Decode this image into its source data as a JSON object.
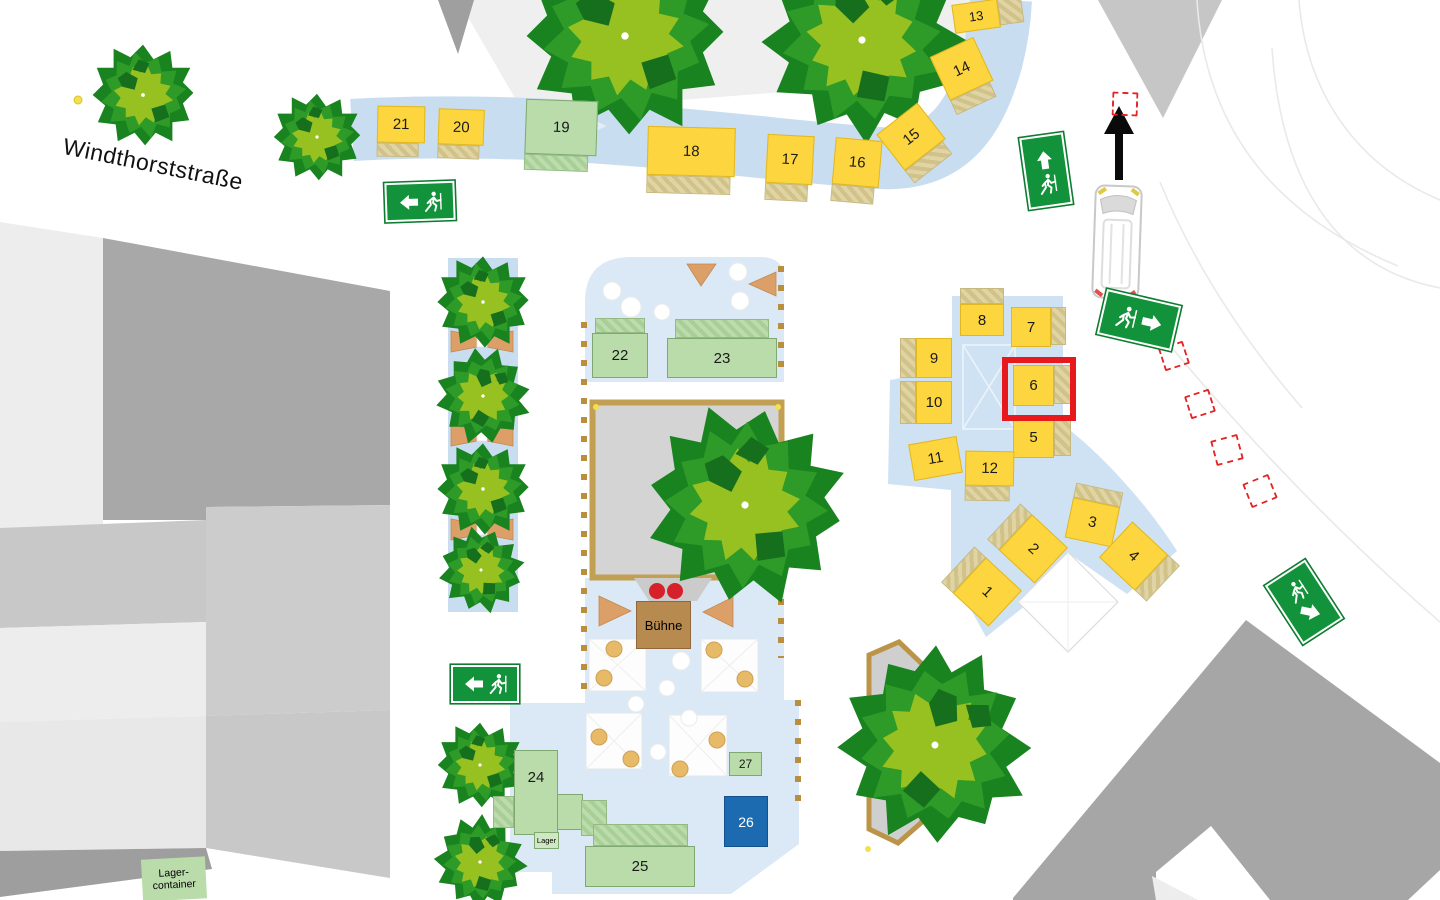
{
  "labels": {
    "street": "Windthorststraße",
    "stage": "Bühne",
    "storage": "Lager",
    "storage_container_line1": "Lager-",
    "storage_container_line2": "container"
  },
  "stalls": [
    {
      "label": "1"
    },
    {
      "label": "2"
    },
    {
      "label": "3"
    },
    {
      "label": "4"
    },
    {
      "label": "5"
    },
    {
      "label": "6"
    },
    {
      "label": "7"
    },
    {
      "label": "8"
    },
    {
      "label": "9"
    },
    {
      "label": "10"
    },
    {
      "label": "11"
    },
    {
      "label": "12"
    },
    {
      "label": "13"
    },
    {
      "label": "14"
    },
    {
      "label": "15"
    },
    {
      "label": "16"
    },
    {
      "label": "17"
    },
    {
      "label": "18"
    },
    {
      "label": "19"
    },
    {
      "label": "20"
    },
    {
      "label": "21"
    },
    {
      "label": "22"
    },
    {
      "label": "23"
    },
    {
      "label": "24"
    },
    {
      "label": "25"
    },
    {
      "label": "26"
    },
    {
      "label": "27"
    }
  ],
  "highlighted_stall": "6",
  "colors": {
    "stall_yellow": "#fcd53f",
    "stall_green": "#b9dcaa",
    "stall_blue": "#1c6ab0",
    "highlight_red": "#e8191c",
    "exit_sign_green": "#12923a",
    "path_blue": "#cfe2f3",
    "plaza_blue": "#dbe9f6",
    "tree_dark_green": "#18831f",
    "tree_light_green": "#97c120",
    "bench_orange": "#dc9f68",
    "stage_brown": "#b78a50",
    "fence_tan": "#b98e3c",
    "fire_access_red": "#e22626",
    "building_gray": "#a8a8a8"
  },
  "icons": {
    "exit_sign_1": "exit-arrow-left",
    "exit_sign_2": "exit-arrow-up",
    "exit_sign_3": "exit-arrow-right",
    "exit_sign_4": "exit-arrow-left",
    "exit_sign_5": "exit-arrow-down-right",
    "vehicle": "bus-top-view",
    "route_arrow": "arrow-up"
  }
}
